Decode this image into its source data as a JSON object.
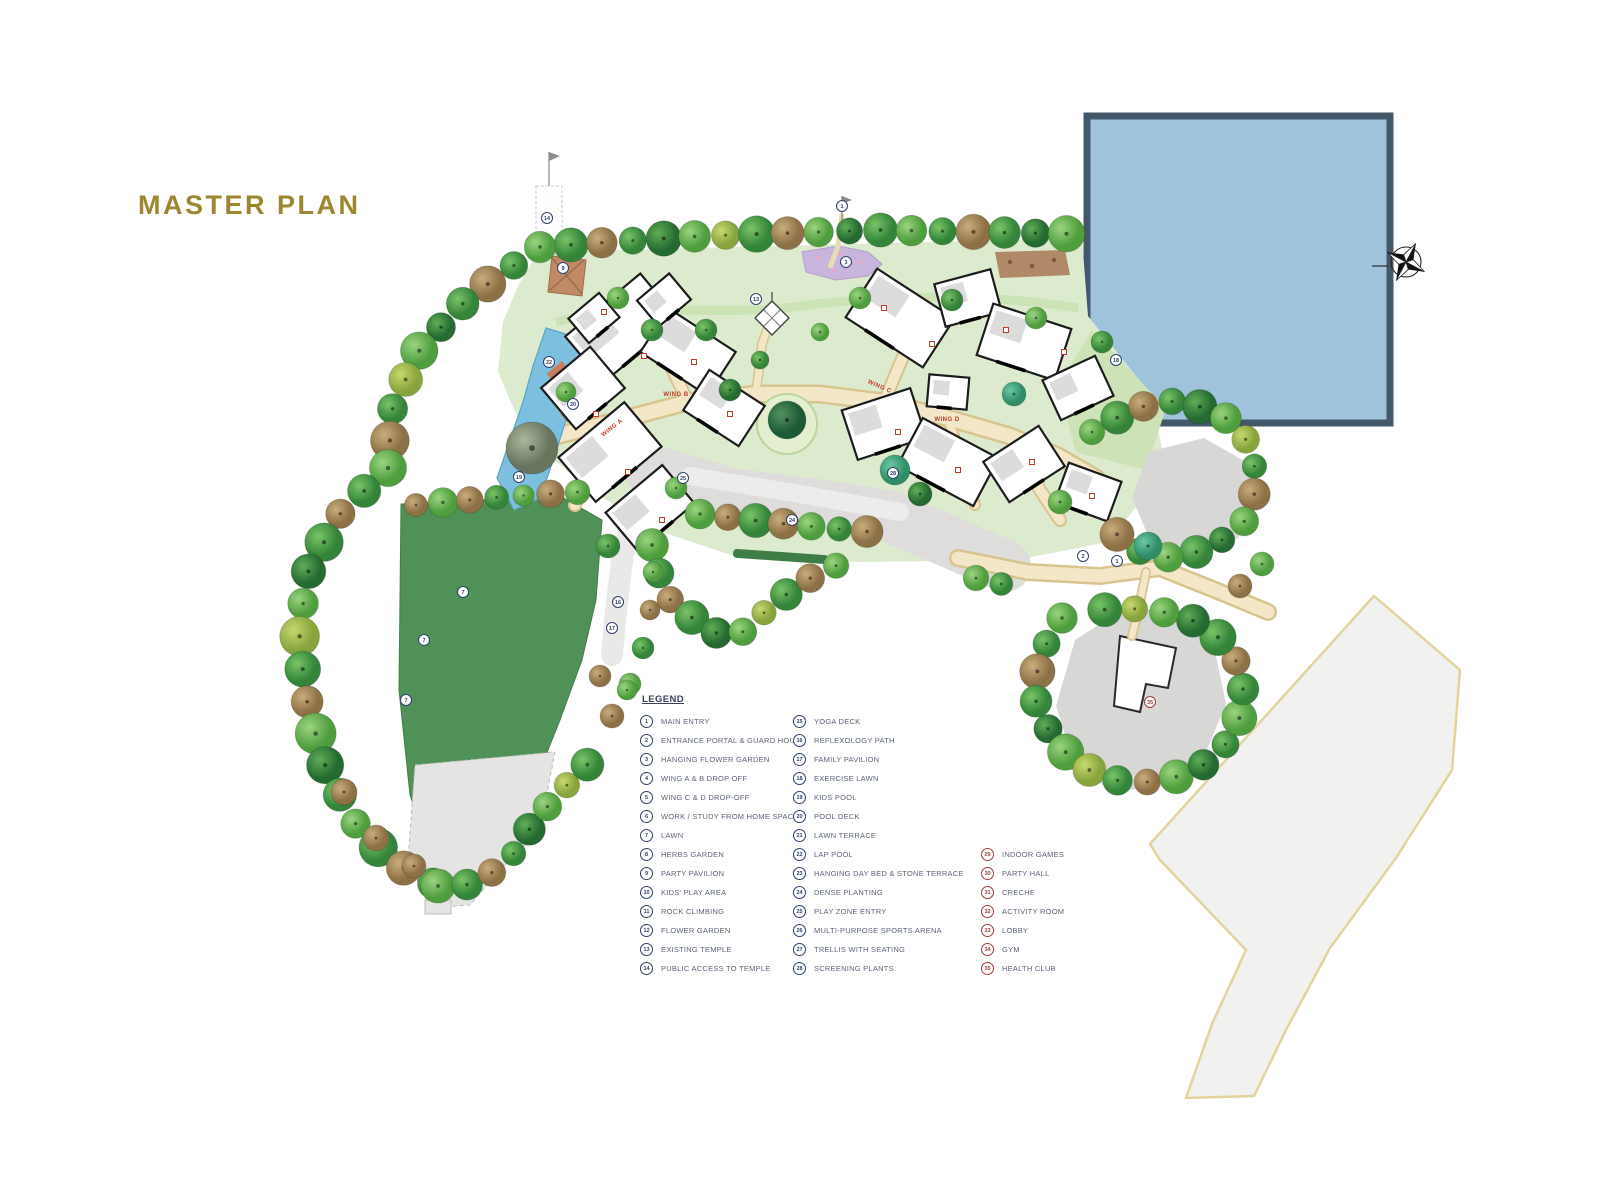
{
  "page": {
    "title": "MASTER PLAN",
    "title_color": "#9c872e"
  },
  "legend": {
    "header": "LEGEND",
    "columns": [
      {
        "accent": "#2e3f6e",
        "items": [
          {
            "num": "1",
            "label": "MAIN ENTRY"
          },
          {
            "num": "2",
            "label": "ENTRANCE PORTAL & GUARD HOUSE"
          },
          {
            "num": "3",
            "label": "HANGING FLOWER GARDEN"
          },
          {
            "num": "4",
            "label": "WING A & B DROP OFF"
          },
          {
            "num": "5",
            "label": "WING C & D DROP-OFF"
          },
          {
            "num": "6",
            "label": "WORK / STUDY FROM HOME SPACES"
          },
          {
            "num": "7",
            "label": "LAWN"
          },
          {
            "num": "8",
            "label": "HERBS GARDEN"
          },
          {
            "num": "9",
            "label": "PARTY PAVILION"
          },
          {
            "num": "10",
            "label": "KIDS' PLAY AREA"
          },
          {
            "num": "11",
            "label": "ROCK CLIMBING"
          },
          {
            "num": "12",
            "label": "FLOWER GARDEN"
          },
          {
            "num": "13",
            "label": "EXISTING TEMPLE"
          },
          {
            "num": "14",
            "label": "PUBLIC ACCESS TO TEMPLE"
          }
        ]
      },
      {
        "accent": "#2e3f6e",
        "items": [
          {
            "num": "15",
            "label": "YOGA DECK"
          },
          {
            "num": "16",
            "label": "REFLEXOLOGY PATH"
          },
          {
            "num": "17",
            "label": "FAMILY PAVILION"
          },
          {
            "num": "18",
            "label": "EXERCISE LAWN"
          },
          {
            "num": "19",
            "label": "KIDS POOL"
          },
          {
            "num": "20",
            "label": "POOL DECK"
          },
          {
            "num": "21",
            "label": "LAWN TERRACE"
          },
          {
            "num": "22",
            "label": "LAP POOL"
          },
          {
            "num": "23",
            "label": "HANGING DAY BED & STONE TERRACE"
          },
          {
            "num": "24",
            "label": "DENSE PLANTING"
          },
          {
            "num": "25",
            "label": "PLAY ZONE ENTRY"
          },
          {
            "num": "26",
            "label": "MULTI-PURPOSE SPORTS ARENA"
          },
          {
            "num": "27",
            "label": "TRELLIS WITH SEATING"
          },
          {
            "num": "28",
            "label": "SCREENING PLANTS"
          }
        ]
      },
      {
        "accent": "#a03c3c",
        "items": [
          {
            "num": "29",
            "label": "INDOOR GAMES"
          },
          {
            "num": "30",
            "label": "PARTY HALL"
          },
          {
            "num": "31",
            "label": "CRECHE"
          },
          {
            "num": "32",
            "label": "ACTIVITY ROOM"
          },
          {
            "num": "33",
            "label": "LOBBY"
          },
          {
            "num": "34",
            "label": "GYM"
          },
          {
            "num": "35",
            "label": "HEALTH CLUB"
          }
        ]
      }
    ]
  },
  "map": {
    "colors": {
      "water": "#9fc3da",
      "water_border": "#44586b",
      "lawn_light": "#dcebcd",
      "lawn_dark": "#4f9156",
      "pool": "#7cbfdf",
      "path": "#f3e7c8",
      "path_edge": "#d9c48f",
      "road": "#f1f1ef",
      "road_edge": "#e2d49c",
      "gray_area": "#d7d7d5",
      "marker": "#2e3f6e",
      "wing_label": "#c0392b"
    },
    "wing_labels": [
      {
        "text": "WING A",
        "x": 613,
        "y": 429,
        "angle": -38
      },
      {
        "text": "WING B",
        "x": 676,
        "y": 396,
        "angle": 0
      },
      {
        "text": "WING C",
        "x": 879,
        "y": 388,
        "angle": 24
      },
      {
        "text": "WING D",
        "x": 947,
        "y": 421,
        "angle": 0
      }
    ],
    "markers": [
      {
        "num": "14",
        "x": 547,
        "y": 218
      },
      {
        "num": "1",
        "x": 842,
        "y": 206
      },
      {
        "num": "13",
        "x": 756,
        "y": 299
      },
      {
        "num": "3",
        "x": 846,
        "y": 262
      },
      {
        "num": "9",
        "x": 563,
        "y": 268
      },
      {
        "num": "22",
        "x": 549,
        "y": 362
      },
      {
        "num": "20",
        "x": 573,
        "y": 404
      },
      {
        "num": "19",
        "x": 519,
        "y": 477
      },
      {
        "num": "7",
        "x": 463,
        "y": 592
      },
      {
        "num": "7",
        "x": 424,
        "y": 640
      },
      {
        "num": "7",
        "x": 406,
        "y": 700
      },
      {
        "num": "25",
        "x": 683,
        "y": 478
      },
      {
        "num": "24",
        "x": 792,
        "y": 520
      },
      {
        "num": "28",
        "x": 893,
        "y": 473
      },
      {
        "num": "16",
        "x": 618,
        "y": 602
      },
      {
        "num": "17",
        "x": 612,
        "y": 628
      },
      {
        "num": "18",
        "x": 1116,
        "y": 360
      },
      {
        "num": "2",
        "x": 1083,
        "y": 556
      },
      {
        "num": "1",
        "x": 1117,
        "y": 561
      },
      {
        "num": "35",
        "x": 1150,
        "y": 702,
        "color": "#a03c3c"
      }
    ]
  }
}
